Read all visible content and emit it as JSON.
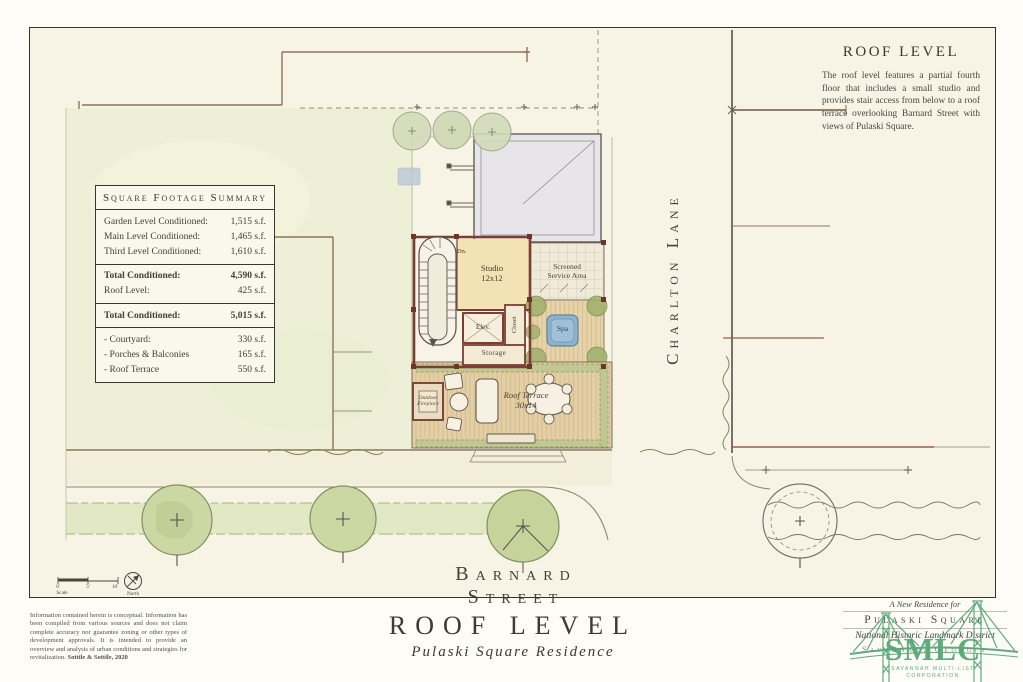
{
  "summary_table": {
    "title": "Square Footage Summary",
    "unit": "s.f.",
    "rows": [
      {
        "label": "Garden Level Conditioned:",
        "value": "1,515 s.f."
      },
      {
        "label": "Main Level Conditioned:",
        "value": "1,465 s.f."
      },
      {
        "label": "Third Level Conditioned:",
        "value": "1,610 s.f."
      },
      {
        "label": "Total Conditioned:",
        "value": "4,590 s.f."
      },
      {
        "label": "Roof Level:",
        "value": "425 s.f."
      },
      {
        "label": "Total Conditioned:",
        "value": "5,015 s.f."
      },
      {
        "label": "- Courtyard:",
        "value": "330 s.f."
      },
      {
        "label": "- Porches & Balconies",
        "value": "165 s.f."
      },
      {
        "label": "- Roof Terrace",
        "value": "550 s.f."
      }
    ]
  },
  "plan_note": {
    "heading": "ROOF LEVEL",
    "body": "The roof level features a partial fourth floor that includes a small studio and provides stair access from below to a roof terrace overlooking Barnard Street with views of Pulaski Square."
  },
  "streets": {
    "bottom": "Barnard Street",
    "right": "Charlton Lane"
  },
  "plan_labels": {
    "studio_line1": "Studio",
    "studio_line2": "12x12",
    "screened_line1": "Screened",
    "screened_line2": "Service Area",
    "elevator": "Elev.",
    "closet": "Closet",
    "storage": "Storage",
    "spa": "Spa",
    "fireplace_line1": "Outdoor",
    "fireplace_line2": "Fireplace",
    "terrace_line1": "Roof Terrace",
    "terrace_line2": "30x14",
    "stair_down": "Dn."
  },
  "scale_bar": {
    "tick_0": "0'",
    "tick_5": "5'",
    "tick_10": "10'",
    "label": "Scale",
    "north_label": "North"
  },
  "title_block": {
    "disclaimer": "Information contained herein is conceptual. Information has been compiled from various sources and does not claim complete accuracy nor guarantee zoning or other types of development approvals. It is intended to provide an overview and analysis of urban conditions and strategies for revitalization.",
    "attribution": "Sottile & Sottile, 2020",
    "title": "ROOF LEVEL",
    "subtitle": "Pulaski Square Residence"
  },
  "stamp": {
    "line1": "A New Residence for",
    "line2": "Pulaski Square",
    "line3": "National Historic Landmark District",
    "line4": "Savannah, Georgia"
  },
  "logo": {
    "monogram": "SMLC",
    "caption_line1": "SAVANNAH MULTI-LIST",
    "caption_line2": "CORPORATION"
  },
  "colors": {
    "paper": "#f8f4e5",
    "lawn_green": "#edf0d6",
    "tree_green": "#ccd8a4",
    "wall_red": "#7b3e32",
    "spa_blue": "#8fb3cf",
    "roof_gray": "#e7e5ea",
    "sepia_line": "#8d7458",
    "logo_green": "#4aa06e",
    "ink": "#3f3a32"
  }
}
